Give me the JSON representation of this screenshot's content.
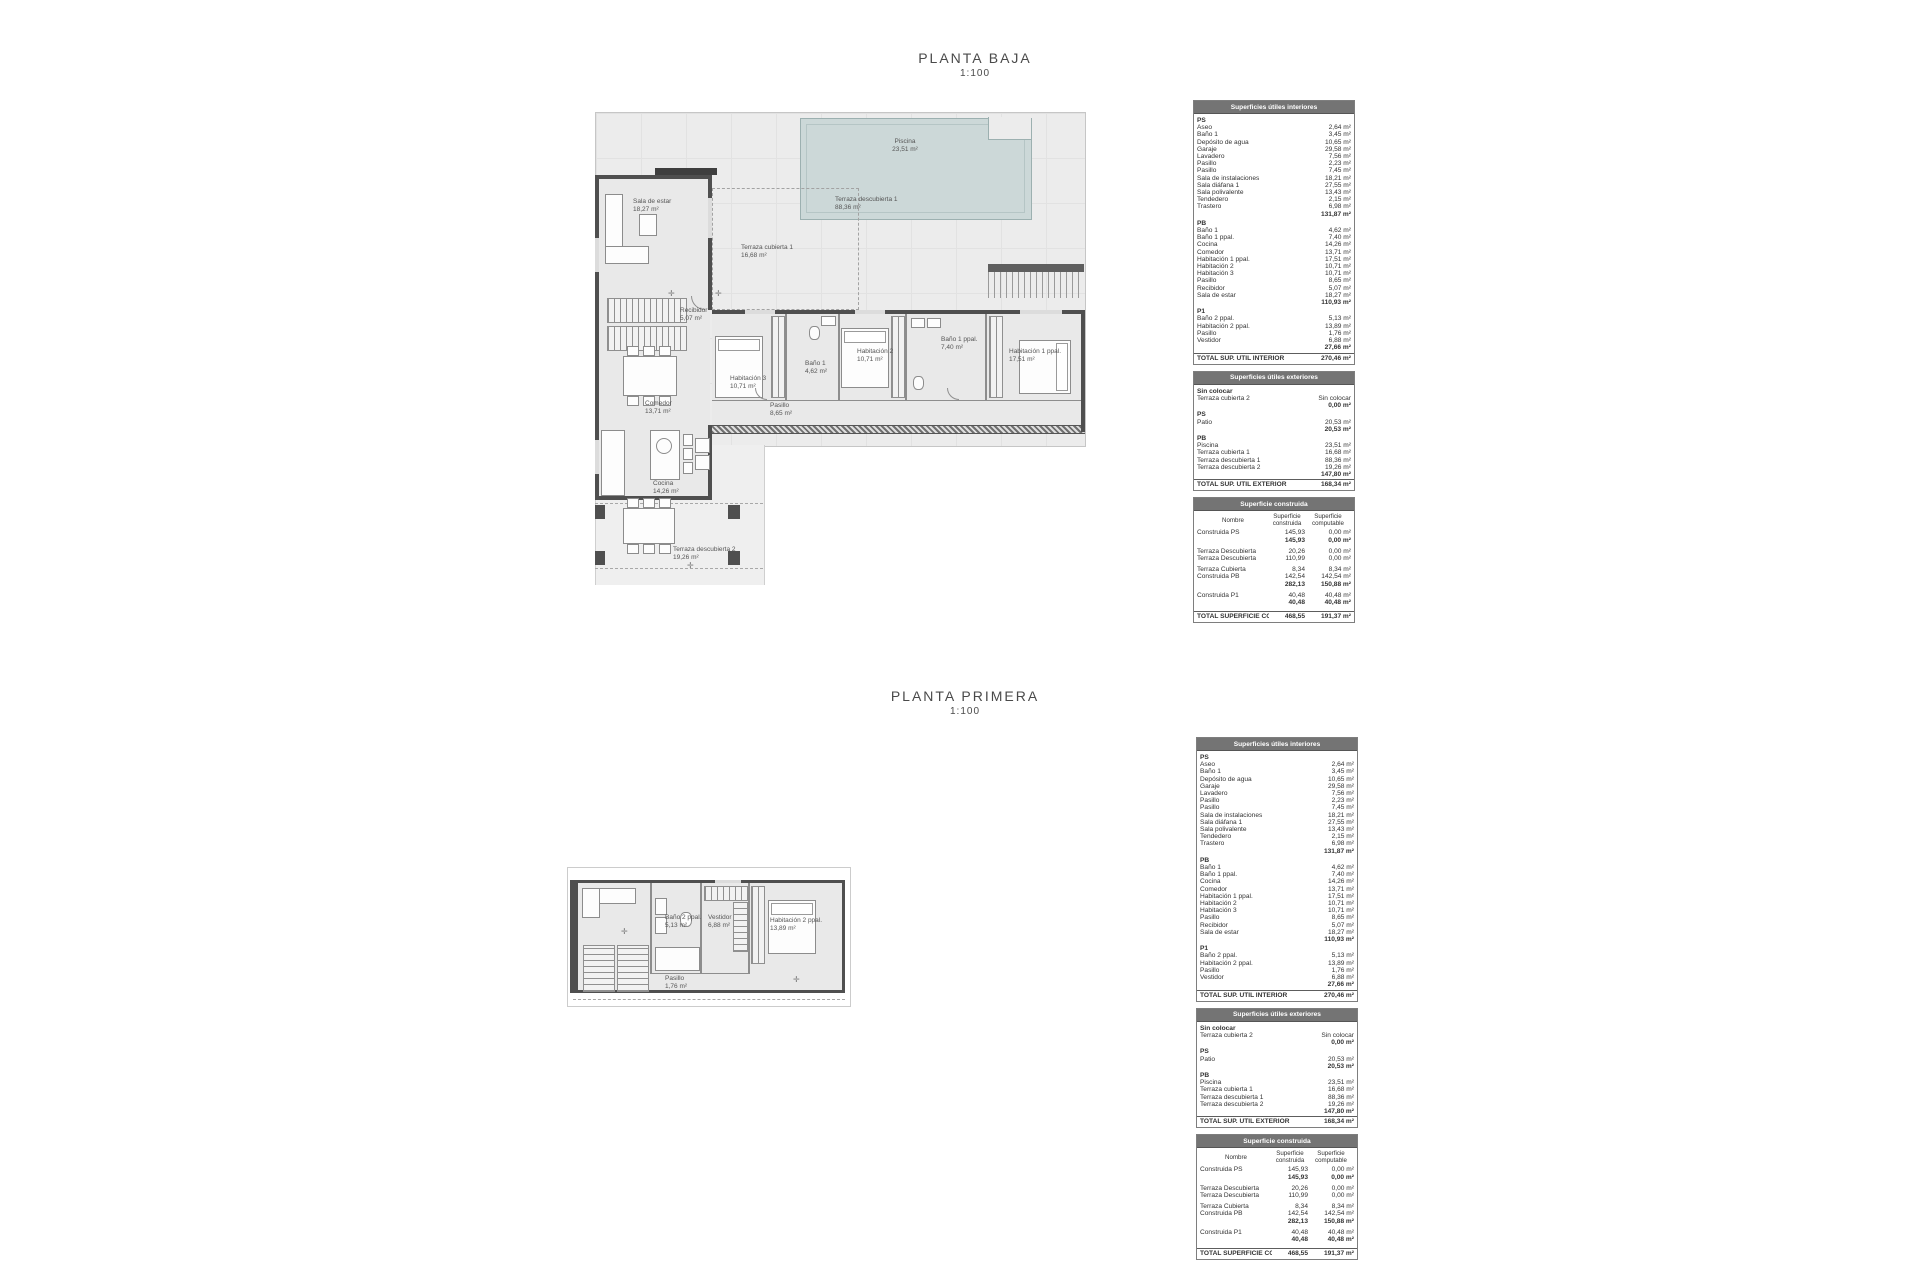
{
  "sheet1": {
    "title": "PLANTA BAJA",
    "scale": "1:100"
  },
  "sheet2": {
    "title": "PLANTA PRIMERA",
    "scale": "1:100"
  },
  "tables": {
    "interior": {
      "header": "Superficies útiles interiores",
      "sections": [
        {
          "label": "PS",
          "rows": [
            [
              "Aseo",
              "2,64 m²"
            ],
            [
              "Baño 1",
              "3,45 m²"
            ],
            [
              "Depósito de agua",
              "10,65 m²"
            ],
            [
              "Garaje",
              "29,58 m²"
            ],
            [
              "Lavadero",
              "7,56 m²"
            ],
            [
              "Pasillo",
              "2,23 m²"
            ],
            [
              "Pasillo",
              "7,45 m²"
            ],
            [
              "Sala de instalaciones",
              "18,21 m²"
            ],
            [
              "Sala diáfana 1",
              "27,55 m²"
            ],
            [
              "Sala polivalente",
              "13,43 m²"
            ],
            [
              "Tendedero",
              "2,15 m²"
            ],
            [
              "Trastero",
              "6,98 m²"
            ]
          ],
          "subtotal": "131,87 m²"
        },
        {
          "label": "PB",
          "rows": [
            [
              "Baño 1",
              "4,62 m²"
            ],
            [
              "Baño 1 ppal.",
              "7,40 m²"
            ],
            [
              "Cocina",
              "14,26 m²"
            ],
            [
              "Comedor",
              "13,71 m²"
            ],
            [
              "Habitación 1 ppal.",
              "17,51 m²"
            ],
            [
              "Habitación 2",
              "10,71 m²"
            ],
            [
              "Habitación 3",
              "10,71 m²"
            ],
            [
              "Pasillo",
              "8,65 m²"
            ],
            [
              "Recibidor",
              "5,07 m²"
            ],
            [
              "Sala de estar",
              "18,27 m²"
            ]
          ],
          "subtotal": "110,93 m²"
        },
        {
          "label": "P1",
          "rows": [
            [
              "Baño 2 ppal.",
              "5,13 m²"
            ],
            [
              "Habitación 2 ppal.",
              "13,89 m²"
            ],
            [
              "Pasillo",
              "1,76 m²"
            ],
            [
              "Vestidor",
              "6,88 m²"
            ]
          ],
          "subtotal": "27,66 m²"
        }
      ],
      "total": {
        "label": "TOTAL SUP.  ÚTIL INTERIOR",
        "value": "270,46 m²"
      }
    },
    "exterior": {
      "header": "Superficies útiles exteriores",
      "sections": [
        {
          "label": "Sin colocar",
          "rows": [
            [
              "Terraza cubierta 2",
              "Sin colocar"
            ]
          ],
          "subtotal": "0,00 m²"
        },
        {
          "label": "PS",
          "rows": [
            [
              "Patio",
              "20,53 m²"
            ]
          ],
          "subtotal": "20,53 m²"
        },
        {
          "label": "PB",
          "rows": [
            [
              "Piscina",
              "23,51 m²"
            ],
            [
              "Terraza cubierta 1",
              "16,68 m²"
            ],
            [
              "Terraza descubierta 1",
              "88,36 m²"
            ],
            [
              "Terraza descubierta 2",
              "19,26 m²"
            ]
          ],
          "subtotal": "147,80 m²"
        }
      ],
      "total": {
        "label": "TOTAL SUP.  ÚTIL EXTERIOR",
        "value": "168,34 m²"
      }
    },
    "built": {
      "header": "Superficie construida",
      "columns": [
        "Nombre",
        "Superficie construida",
        "Superficie computable"
      ],
      "groups": [
        {
          "rows": [
            [
              "Construida PS",
              "145,93",
              "0,00 m²"
            ]
          ],
          "subtotal": [
            "145,93",
            "0,00 m²"
          ]
        },
        {
          "rows": [
            [
              "Terraza Descubierta",
              "20,26",
              "0,00 m²"
            ],
            [
              "Terraza Descubierta",
              "110,99",
              "0,00 m²"
            ]
          ]
        },
        {
          "rows": [
            [
              "Terraza Cubierta",
              "8,34",
              "8,34 m²"
            ],
            [
              "Construida PB",
              "142,54",
              "142,54 m²"
            ]
          ],
          "subtotal": [
            "282,13",
            "150,88 m²"
          ]
        },
        {
          "rows": [
            [
              "Construida P1",
              "40,48",
              "40,48 m²"
            ]
          ],
          "subtotal": [
            "40,48",
            "40,48 m²"
          ]
        }
      ],
      "total": {
        "label": "TOTAL SUPERFICIE CONSTRUIDA:",
        "values": [
          "468,55",
          "191,37 m²"
        ]
      }
    }
  },
  "plan_baja": {
    "labels": [
      {
        "name": "Piscina",
        "area": "23,51 m²"
      },
      {
        "name": "Terraza descubierta 1",
        "area": "88,36 m²"
      },
      {
        "name": "Sala de estar",
        "area": "18,27 m²"
      },
      {
        "name": "Terraza cubierta 1",
        "area": "16,68 m²"
      },
      {
        "name": "Recibidor",
        "area": "5,07 m²"
      },
      {
        "name": "Comedor",
        "area": "13,71 m²"
      },
      {
        "name": "Cocina",
        "area": "14,26 m²"
      },
      {
        "name": "Terraza descubierta 2",
        "area": "19,26 m²"
      },
      {
        "name": "Habitación 3",
        "area": "10,71 m²"
      },
      {
        "name": "Baño 1",
        "area": "4,62 m²"
      },
      {
        "name": "Habitación 2",
        "area": "10,71 m²"
      },
      {
        "name": "Baño 1 ppal.",
        "area": "7,40 m²"
      },
      {
        "name": "Habitación 1 ppal.",
        "area": "17,51 m²"
      },
      {
        "name": "Pasillo",
        "area": "8,65 m²"
      }
    ]
  },
  "plan_primera": {
    "labels": [
      {
        "name": "Baño 2 ppal.",
        "area": "5,13 m²"
      },
      {
        "name": "Vestidor",
        "area": "6,88 m²"
      },
      {
        "name": "Habitación 2 ppal.",
        "area": "13,89 m²"
      },
      {
        "name": "Pasillo",
        "area": "1,76 m²"
      }
    ]
  }
}
